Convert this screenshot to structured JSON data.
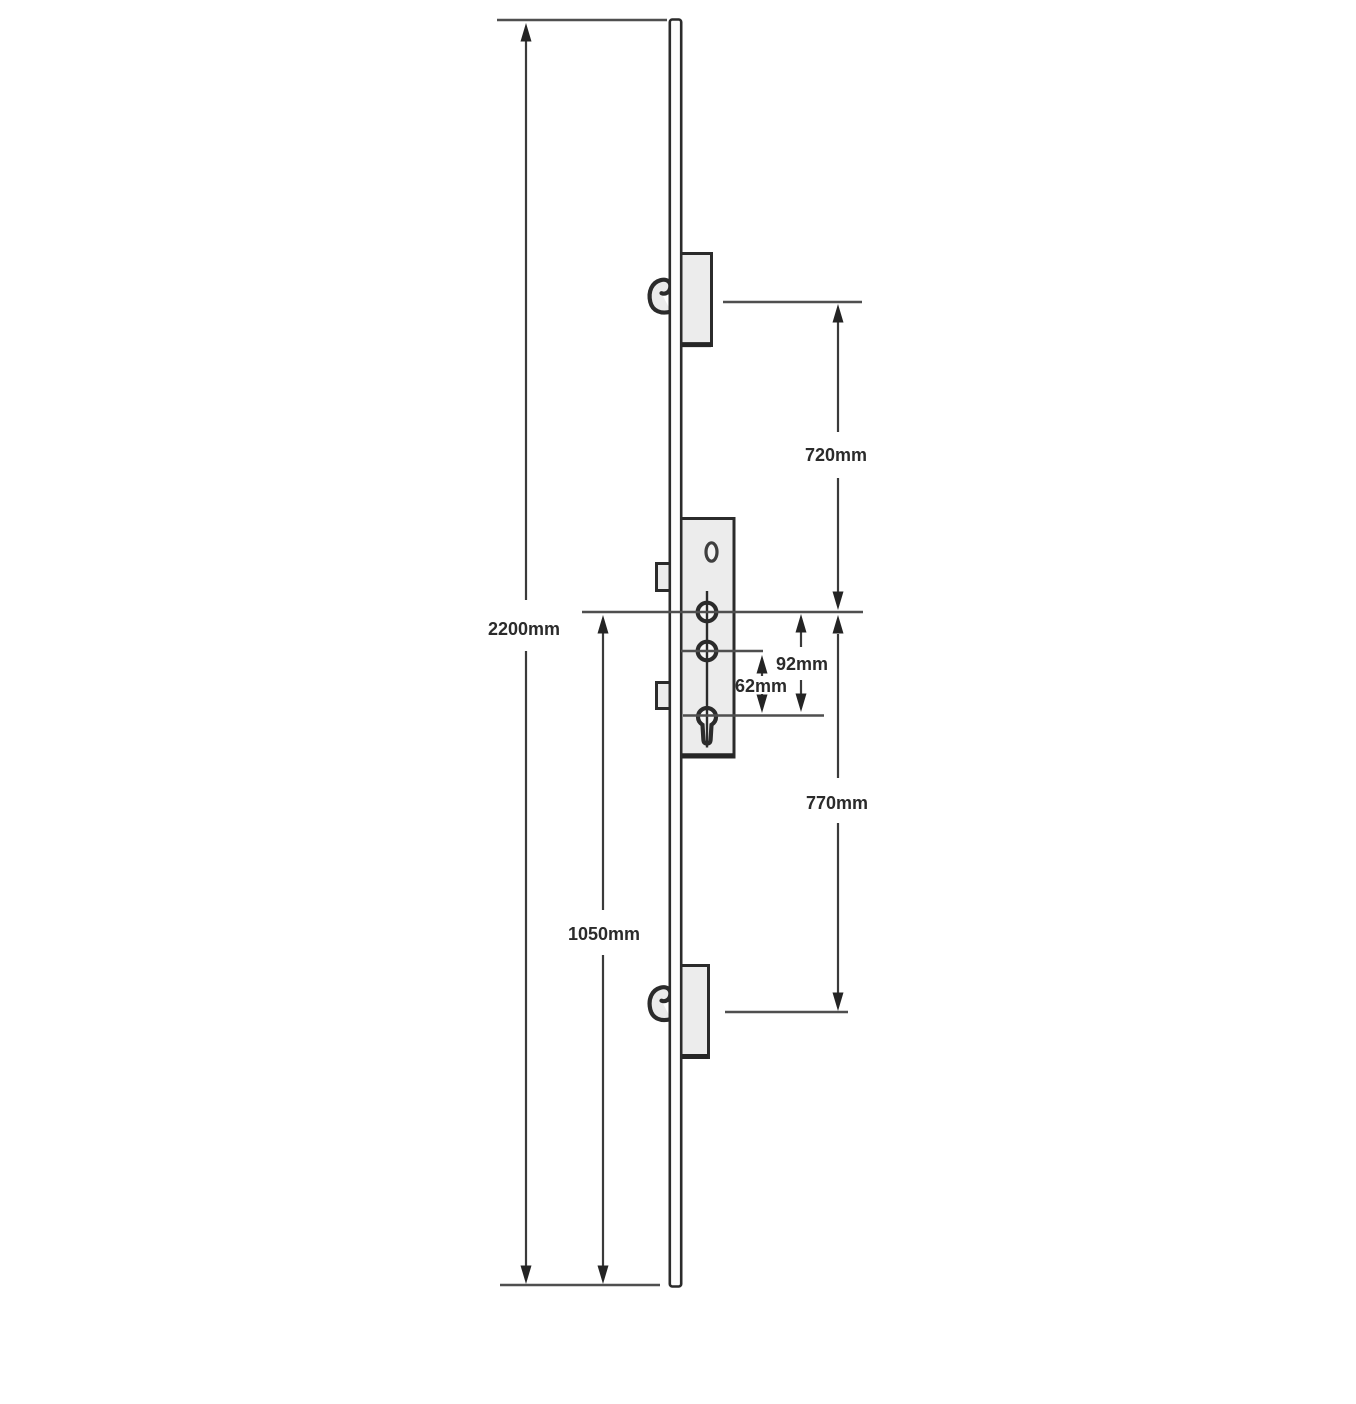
{
  "diagram": {
    "dimensions": {
      "overall_length": "2200mm",
      "centre_to_bottom_end": "1050mm",
      "top_hook_to_centre": "720mm",
      "centre_to_bottom_hook": "770mm",
      "handle_to_cylinder": "92mm",
      "lower_spindle_to_cylinder": "62mm"
    },
    "colors": {
      "background": "#ffffff",
      "outline": "#2b2b2b",
      "dimension_line": "#3a3a3a",
      "reference_line": "#4f4f4f",
      "case_fill": "#ececec",
      "strip_fill": "#fdfdfd",
      "hole_fill": "#f8f8f8",
      "label_text": "#2b2b2b"
    }
  }
}
